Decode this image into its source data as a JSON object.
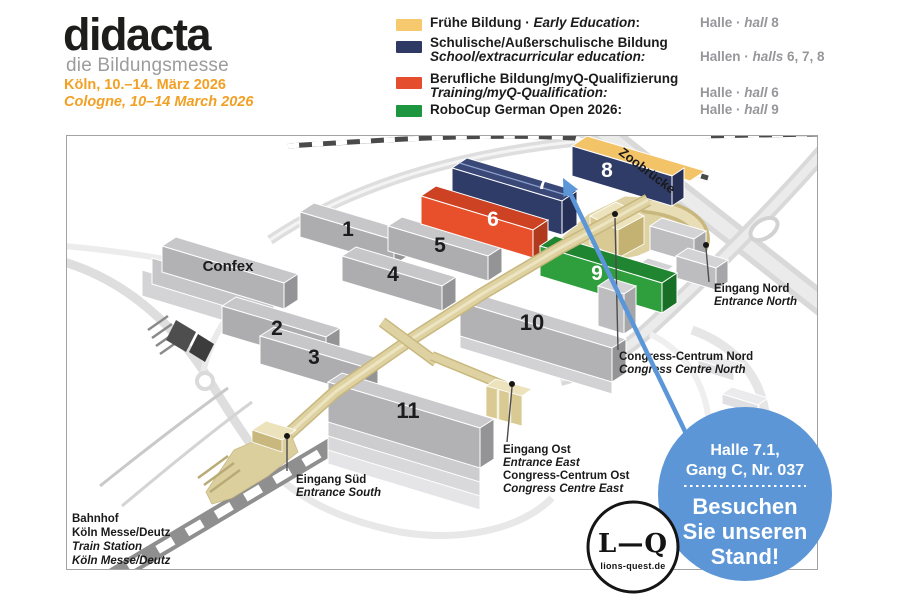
{
  "header": {
    "brand": "didacta",
    "brand_sub": "die Bildungsmesse",
    "date_de": "Köln, 10.–14. März 2026",
    "date_en": "Cologne, 10–14 March 2026"
  },
  "legend": {
    "items": [
      {
        "color": "#F6C96F",
        "de": "Frühe Bildung · ",
        "en": "Early Education",
        "punct": ":",
        "hall_pre": "Halle · ",
        "hall_it": "hall",
        "hall_no": " 8"
      },
      {
        "color": "#2F3A64",
        "de": "Schulische/Außerschulische Bildung",
        "en": "School/extracurricular education:",
        "hall_pre": "Hallen · ",
        "hall_it": "halls",
        "hall_no": " 6, 7, 8"
      },
      {
        "color": "#E44D2E",
        "de": "Berufliche Bildung/myQ-Qualifizierung",
        "en": "Training/myQ-Qualification:",
        "hall_pre": "Halle · ",
        "hall_it": "hall",
        "hall_no": " 6"
      },
      {
        "color": "#1E9640",
        "de": "RoboCup German Open 2026:",
        "en": "",
        "hall_pre": "Halle · ",
        "hall_it": "hall",
        "hall_no": " 9"
      }
    ]
  },
  "map": {
    "halls": [
      "1",
      "2",
      "3",
      "4",
      "5",
      "6",
      "7",
      "8",
      "9",
      "10",
      "11"
    ],
    "confex": "Confex",
    "zoobruecke": "Zoobrücke",
    "entrance_north_de": "Eingang Nord",
    "entrance_north_en": "Entrance North",
    "congress_north_de": "Congress-Centrum Nord",
    "congress_north_en": "Congress Centre North",
    "entrance_east_de": "Eingang Ost",
    "entrance_east_en": "Entrance East",
    "congress_east_de": "Congress-Centrum Ost",
    "congress_east_en": "Congress Centre East",
    "entrance_south_de": "Eingang Süd",
    "entrance_south_en": "Entrance South",
    "station_l1": "Bahnhof",
    "station_l2": "Köln Messe/Deutz",
    "station_l3": "Train Station",
    "station_l4": "Köln Messe/Deutz"
  },
  "badge": {
    "hall_line1": "Halle 7.1,",
    "hall_line2": "Gang C, Nr. 037",
    "cta_line1": "Besuchen",
    "cta_line2": "Sie unseren",
    "cta_line3": "Stand!"
  },
  "lq": {
    "monogram": "L—Q",
    "domain": "lions-quest.de"
  },
  "colors": {
    "brand_orange": "#F2A024",
    "hall_yellow": "#F3C368",
    "hall_navy": "#303C68",
    "hall_red": "#E8502C",
    "hall_green": "#2F9E3C",
    "beige": "#DFD2A2",
    "badge_blue": "#5C96D6",
    "arrow_blue": "#5B97D8",
    "legend_gray": "#97979B"
  }
}
